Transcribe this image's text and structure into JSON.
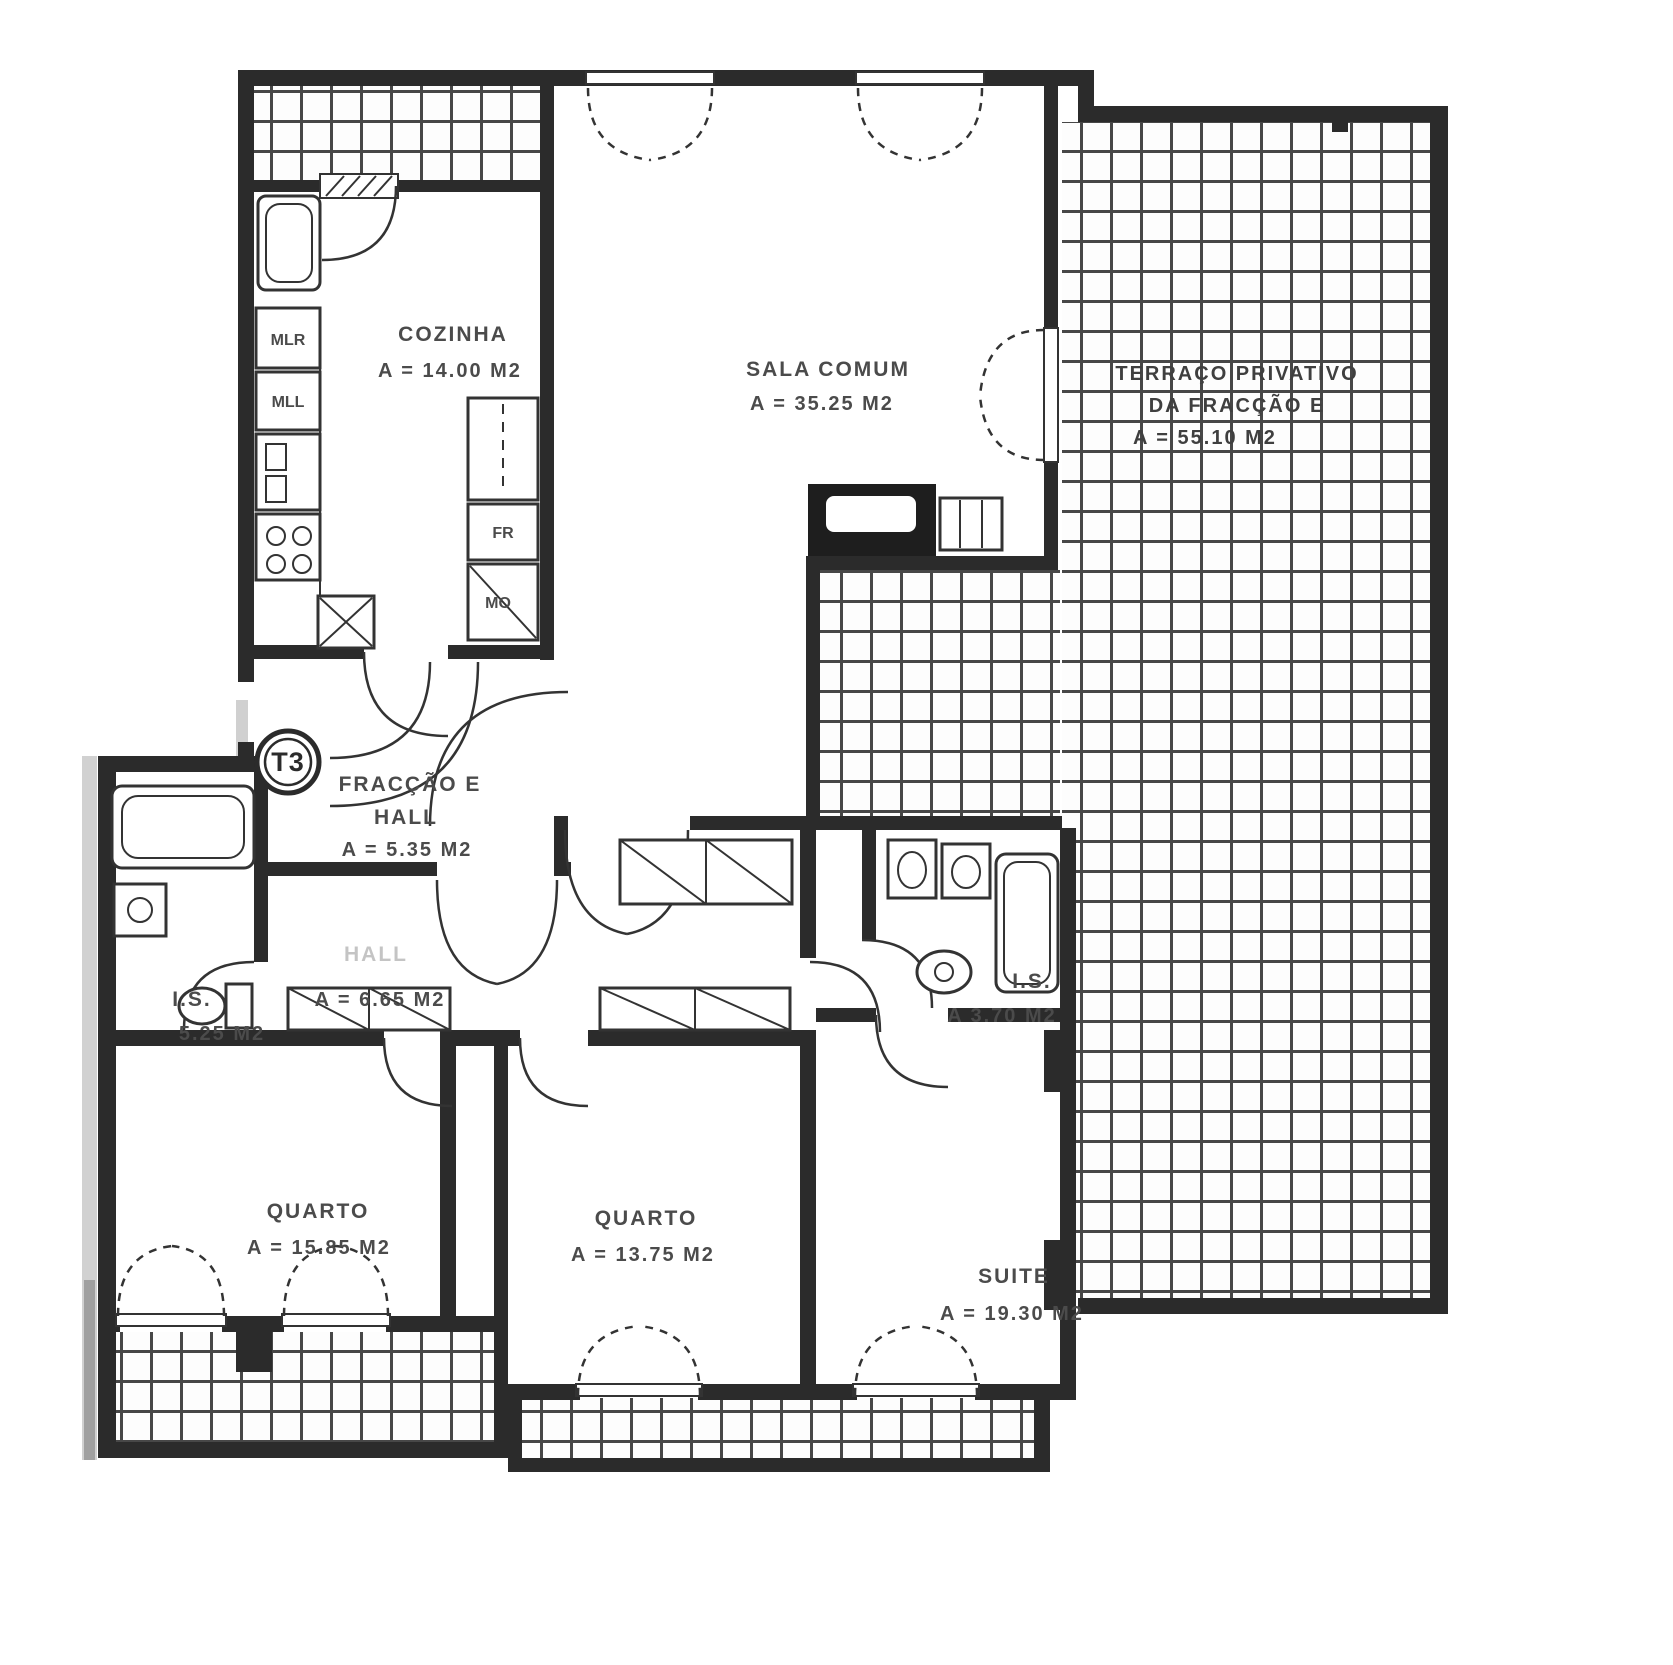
{
  "plan": {
    "unit_badge": "T3",
    "rooms": {
      "cozinha": {
        "name": "COZINHA",
        "area": "A = 14.00 M2"
      },
      "sala": {
        "name": "SALA COMUM",
        "area": "A = 35.25 M2"
      },
      "terraco": {
        "name_line1": "TERRAÇO PRIVATIVO",
        "name_line2": "DA FRACÇÃO E",
        "area": "A = 55.10 M2"
      },
      "hall_entrada": {
        "name_line1": "FRACÇÃO E",
        "name_line2": "HALL",
        "area": "A = 5.35 M2"
      },
      "hall_interior": {
        "name": "HALL",
        "area": "A = 6.65 M2"
      },
      "is_esquerda": {
        "name": "I.S.",
        "area": "5.25 M2"
      },
      "is_direita": {
        "name": "I.S.",
        "area": "A  3.70  M2"
      },
      "quarto_1": {
        "name": "QUARTO",
        "area": "A = 15.85 M2"
      },
      "quarto_2": {
        "name": "QUARTO",
        "area": "A = 13.75 M2"
      },
      "suite": {
        "name": "SUITE",
        "area": "A = 19.30 M2"
      }
    },
    "appliances": {
      "mlr": "MLR",
      "mll": "MLL",
      "fr": "FR",
      "mo": "MO"
    },
    "colors": {
      "ink": "#2b2b2b",
      "label": "#4b4b4b",
      "paper": "#ffffff",
      "tile_line": "#474747"
    }
  }
}
